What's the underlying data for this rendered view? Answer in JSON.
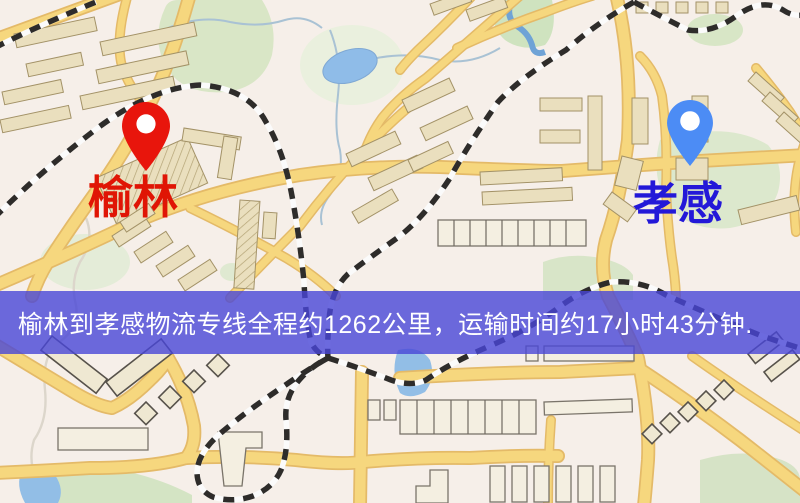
{
  "map": {
    "origin": {
      "name": "榆林",
      "icon": "red-location-pin-icon",
      "pin_color": "#e8150c",
      "label_color": "#e01505"
    },
    "destination": {
      "name": "孝感",
      "icon": "blue-location-pin-icon",
      "pin_color": "#4c8cf5",
      "label_color": "#2318d8"
    },
    "banner": {
      "text": "榆林到孝感物流专线全程约1262公里，运输时间约17小时43分钟.",
      "bg_color": "rgba(73,70,215,0.8)",
      "text_color": "#ffffff"
    },
    "route": {
      "distance_km": "1262",
      "duration": "17小时43分钟"
    },
    "legend_colors": {
      "road": "#f6d77e",
      "building": "#eadfbe",
      "park": "#dce8cd",
      "water": "#92bee6",
      "railway": "#2e2c2a"
    }
  }
}
